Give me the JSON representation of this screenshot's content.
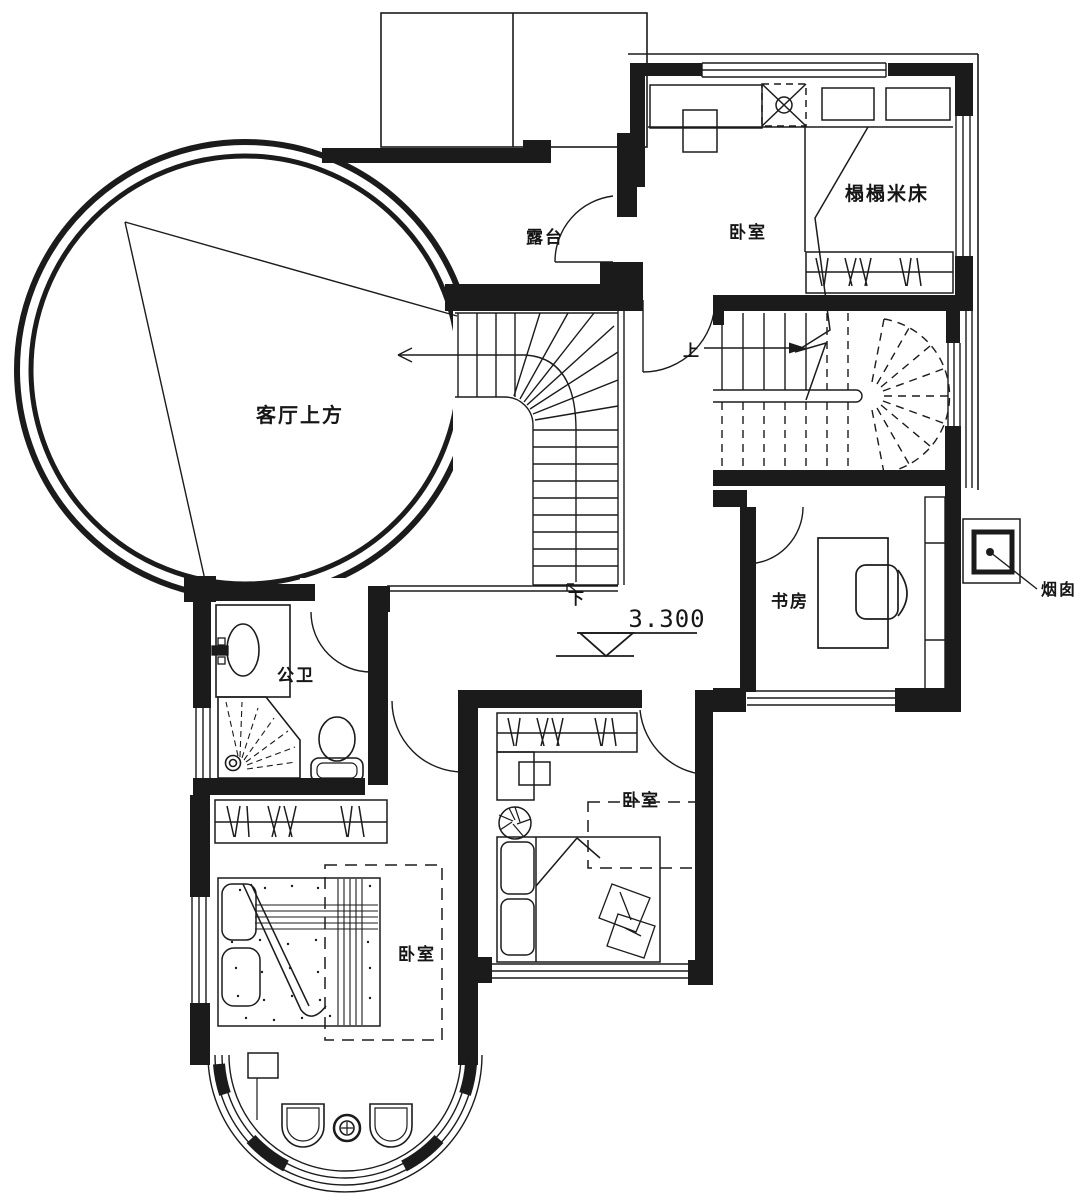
{
  "drawing": {
    "type": "floor-plan",
    "background": "#ffffff",
    "line_color": "#1b1b1b"
  },
  "labels": {
    "living_above": "客厅上方",
    "terrace": "露台",
    "bedroom_top": "卧室",
    "tatami_bed": "榻榻米床",
    "study": "书房",
    "chimney": "烟囱",
    "bathroom": "公卫",
    "bedroom_left": "卧室",
    "bedroom_middle": "卧室",
    "stair_up": "上",
    "stair_down": "下",
    "elevation": "3.300"
  },
  "rooms": [
    {
      "name": "living-room-void",
      "label_key": "living_above"
    },
    {
      "name": "terrace",
      "label_key": "terrace"
    },
    {
      "name": "bedroom-top",
      "label_key": "bedroom_top"
    },
    {
      "name": "study",
      "label_key": "study"
    },
    {
      "name": "bathroom",
      "label_key": "bathroom"
    },
    {
      "name": "bedroom-left",
      "label_key": "bedroom_left"
    },
    {
      "name": "bedroom-middle",
      "label_key": "bedroom_middle"
    }
  ]
}
